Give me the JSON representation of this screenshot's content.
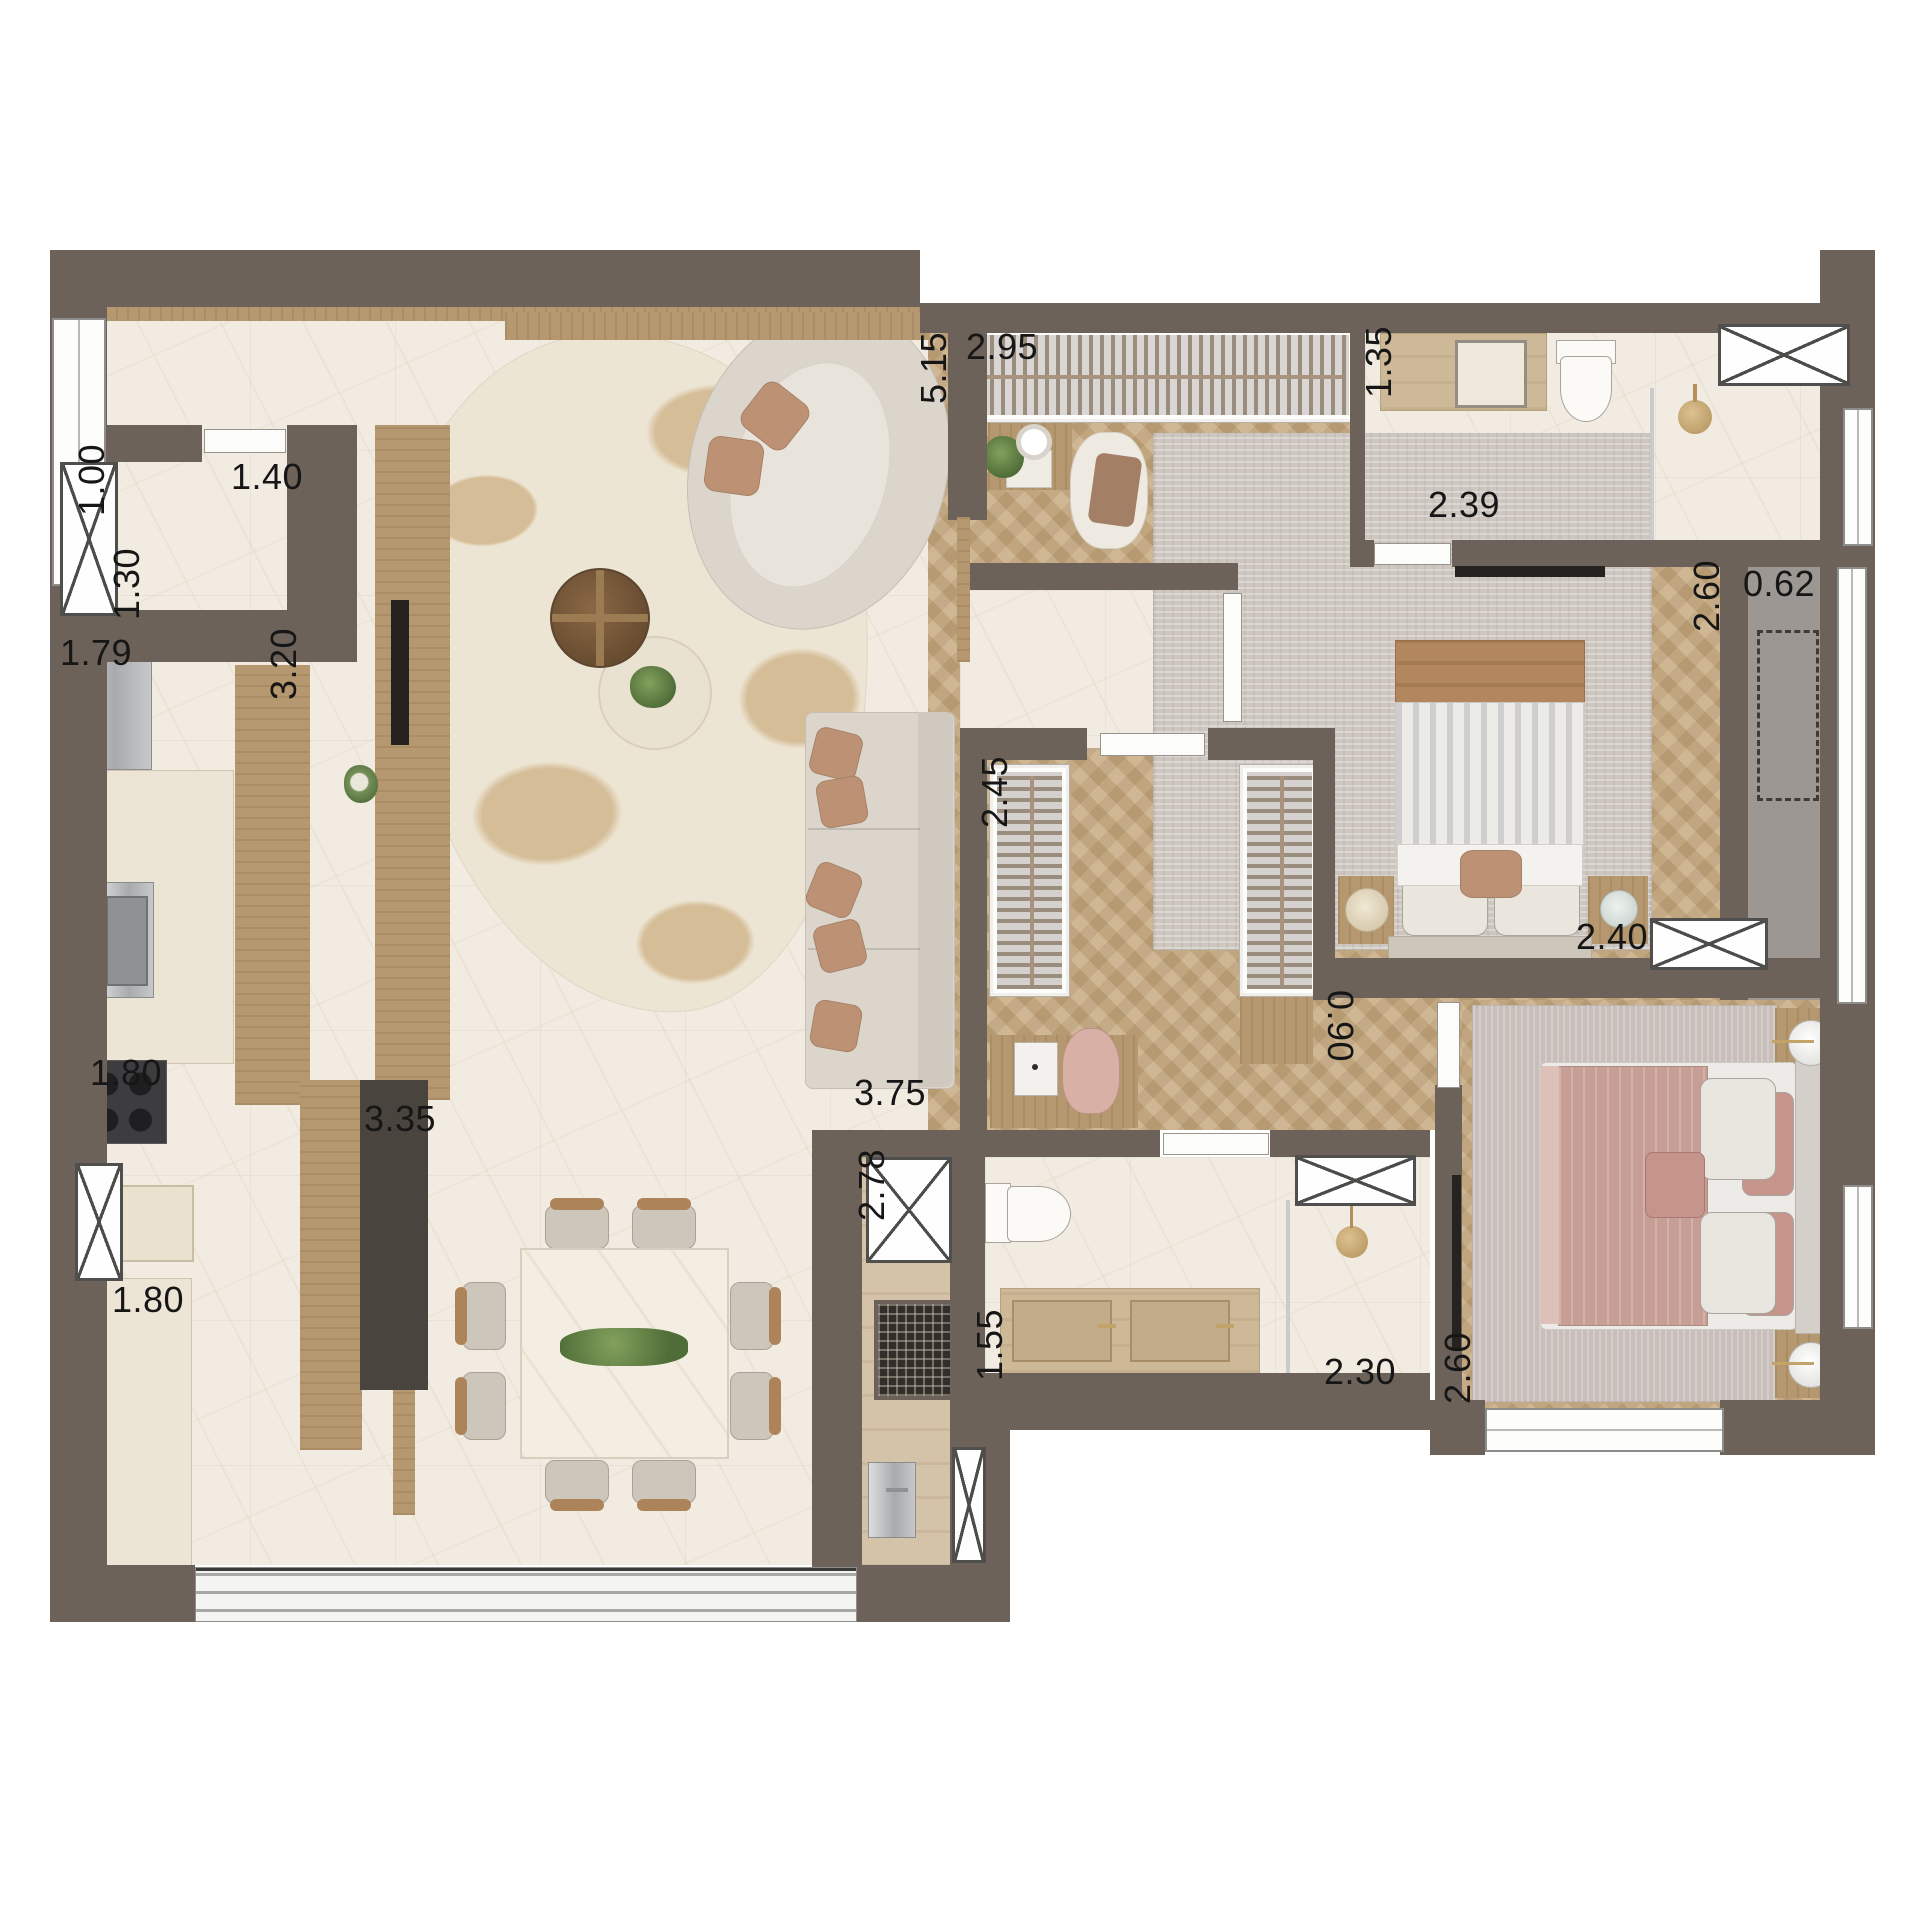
{
  "floor_plan": {
    "canvas": {
      "width": 1920,
      "height": 1920,
      "background": "#ffffff"
    },
    "palette": {
      "wall": "#6C6259",
      "marble_floor": "#F1EBE1",
      "wood_floor": "#C9AE86",
      "travertine_floor": "#D5C3A9",
      "balcony_floor": "#9C9792",
      "furniture_wood": "#B5986F",
      "dark_counter": "#4A443E",
      "sofa": "#DBD5CC",
      "pillow_brown": "#BD9274",
      "rug_cream": "#EDE5D3",
      "rug_spot": "#D5BD98",
      "rug_gray": "#CEC7C0",
      "rug_mauve": "#C8BFBA",
      "bed_pink": "#C79E95",
      "gold": "#C2A369",
      "label_text": "#161616"
    },
    "dimension_labels": [
      {
        "value": "1.00",
        "x": 92,
        "y": 480,
        "orientation": "v"
      },
      {
        "value": "1.40",
        "x": 267,
        "y": 477,
        "orientation": "h"
      },
      {
        "value": "1.30",
        "x": 127,
        "y": 584,
        "orientation": "v"
      },
      {
        "value": "1.79",
        "x": 96,
        "y": 653,
        "orientation": "h"
      },
      {
        "value": "3.20",
        "x": 284,
        "y": 664,
        "orientation": "v"
      },
      {
        "value": "1.80",
        "x": 126,
        "y": 1073,
        "orientation": "h"
      },
      {
        "value": "1.80",
        "x": 148,
        "y": 1300,
        "orientation": "h"
      },
      {
        "value": "3.35",
        "x": 400,
        "y": 1119,
        "orientation": "h"
      },
      {
        "value": "5.15",
        "x": 934,
        "y": 368,
        "orientation": "v"
      },
      {
        "value": "2.95",
        "x": 1002,
        "y": 347,
        "orientation": "h"
      },
      {
        "value": "1.35",
        "x": 1379,
        "y": 362,
        "orientation": "v"
      },
      {
        "value": "2.39",
        "x": 1464,
        "y": 505,
        "orientation": "h"
      },
      {
        "value": "2.60",
        "x": 1707,
        "y": 596,
        "orientation": "v"
      },
      {
        "value": "0.62",
        "x": 1779,
        "y": 584,
        "orientation": "h"
      },
      {
        "value": "2.40",
        "x": 1612,
        "y": 937,
        "orientation": "h"
      },
      {
        "value": "0.90",
        "x": 1340,
        "y": 1026,
        "orientation": "v-flip"
      },
      {
        "value": "2.45",
        "x": 995,
        "y": 792,
        "orientation": "v"
      },
      {
        "value": "3.75",
        "x": 890,
        "y": 1093,
        "orientation": "h"
      },
      {
        "value": "2.78",
        "x": 872,
        "y": 1185,
        "orientation": "v"
      },
      {
        "value": "1.55",
        "x": 990,
        "y": 1345,
        "orientation": "v"
      },
      {
        "value": "2.30",
        "x": 1360,
        "y": 1372,
        "orientation": "h"
      },
      {
        "value": "2.60",
        "x": 1458,
        "y": 1368,
        "orientation": "v"
      }
    ]
  }
}
